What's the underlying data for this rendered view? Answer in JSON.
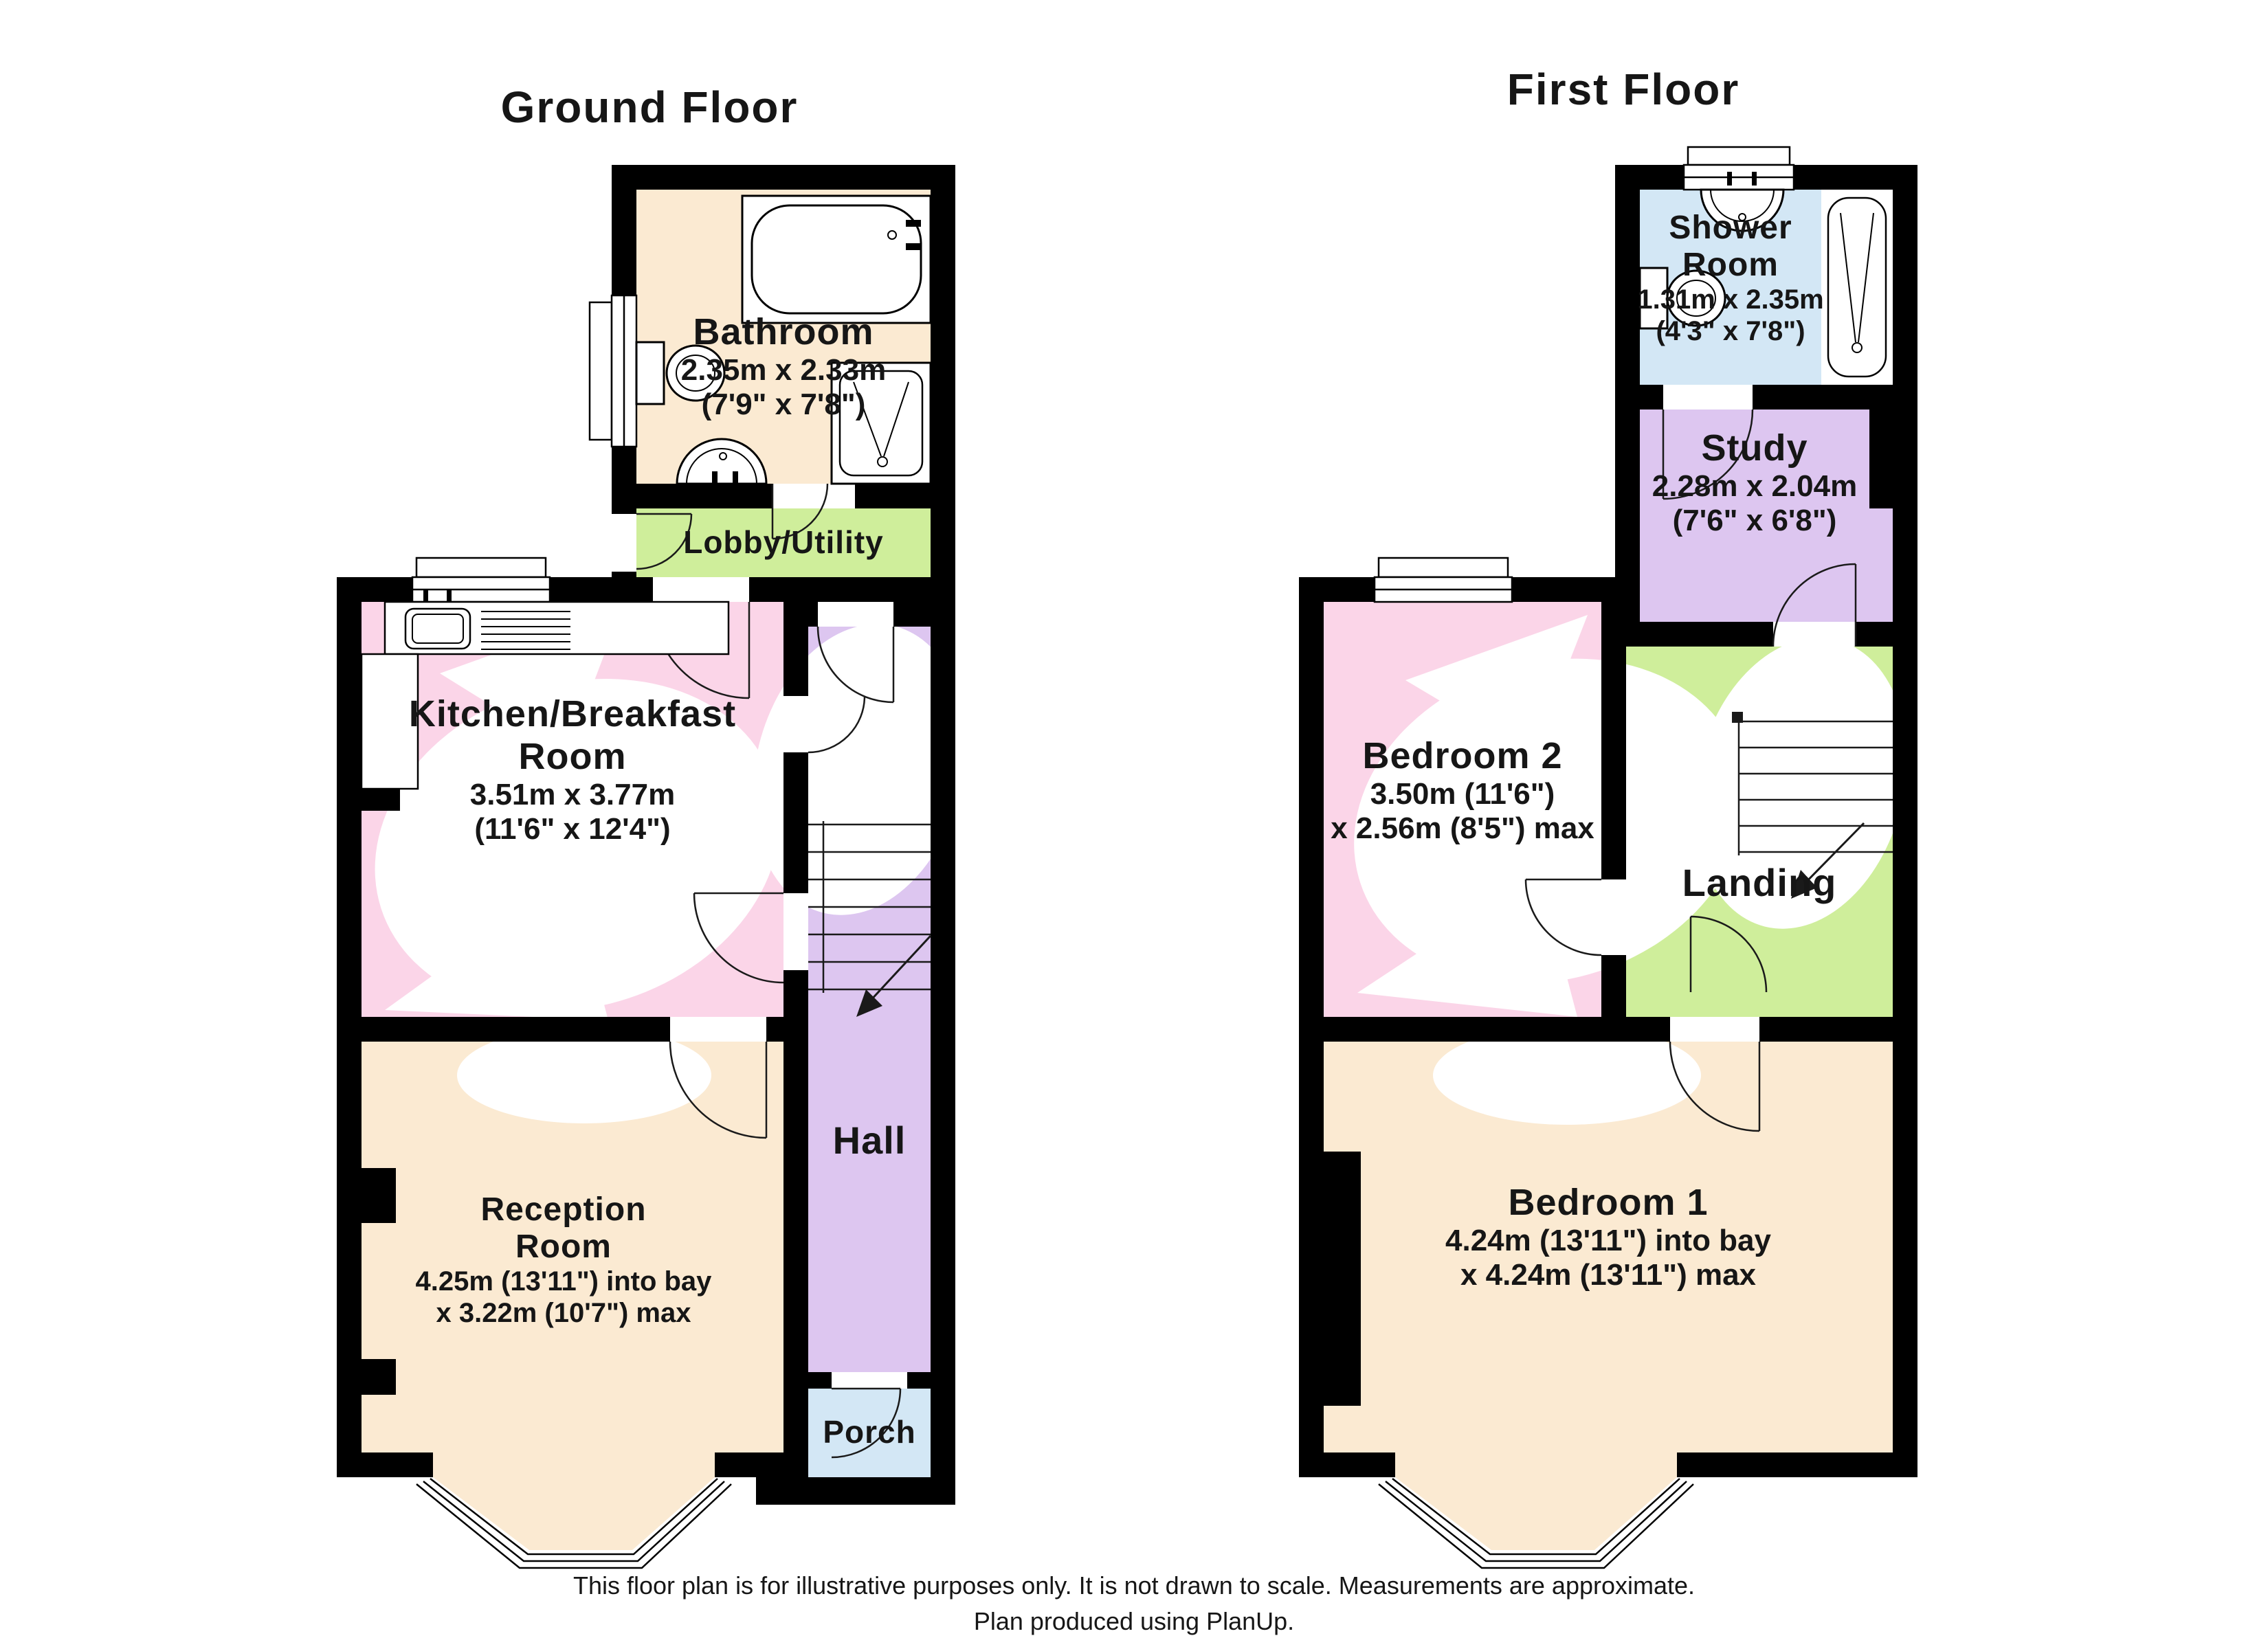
{
  "page": {
    "background": "#FFFFFF"
  },
  "colors": {
    "wall": "#000000",
    "text": "#161616",
    "cream": "#FBEAD2",
    "pink": "#FBD5E8",
    "purple": "#DDC6F0",
    "green": "#CFEE9B",
    "blue": "#D3E7F5"
  },
  "floors": [
    {
      "id": "ground",
      "title": "Ground Floor",
      "rooms": [
        {
          "id": "bathroom",
          "name": "Bathroom",
          "dim_metric": "2.35m x 2.33m",
          "dim_imperial": "(7'9\" x 7'8\")"
        },
        {
          "id": "lobby_utility",
          "name": "Lobby/Utility"
        },
        {
          "id": "kitchen",
          "name": "Kitchen/Breakfast Room",
          "name_line1": "Kitchen/Breakfast",
          "name_line2": "Room",
          "dim_metric": "3.51m x 3.77m",
          "dim_imperial": "(11'6\" x 12'4\")"
        },
        {
          "id": "hall",
          "name": "Hall"
        },
        {
          "id": "reception",
          "name": "Reception Room",
          "name_line1": "Reception",
          "name_line2": "Room",
          "dim_metric": "4.25m (13'11\") into bay",
          "dim_imperial": "x 3.22m (10'7\") max"
        },
        {
          "id": "porch",
          "name": "Porch"
        }
      ]
    },
    {
      "id": "first",
      "title": "First Floor",
      "rooms": [
        {
          "id": "shower_room",
          "name": "Shower Room",
          "name_line1": "Shower",
          "name_line2": "Room",
          "dim_metric": "1.31m x 2.35m",
          "dim_imperial": "(4'3\" x 7'8\")"
        },
        {
          "id": "study",
          "name": "Study",
          "dim_metric": "2.28m x 2.04m",
          "dim_imperial": "(7'6\" x 6'8\")"
        },
        {
          "id": "bedroom2",
          "name": "Bedroom 2",
          "dim_metric": "3.50m (11'6\")",
          "dim_imperial": "x 2.56m (8'5\") max"
        },
        {
          "id": "landing",
          "name": "Landing"
        },
        {
          "id": "bedroom1",
          "name": "Bedroom 1",
          "dim_metric": "4.24m (13'11\") into bay",
          "dim_imperial": "x 4.24m (13'11\") max"
        }
      ]
    }
  ],
  "icons": [
    "bath-icon",
    "toilet-icon",
    "pedestal-sink-icon",
    "shower-tray-icon",
    "kitchen-sink-icon",
    "stairs-icon",
    "door-swing-icon",
    "window-icon",
    "bay-window-icon"
  ],
  "footer": {
    "line1": "This floor plan is for illustrative purposes only. It is not drawn to scale. Measurements are approximate.",
    "line2": "Plan produced using PlanUp."
  }
}
